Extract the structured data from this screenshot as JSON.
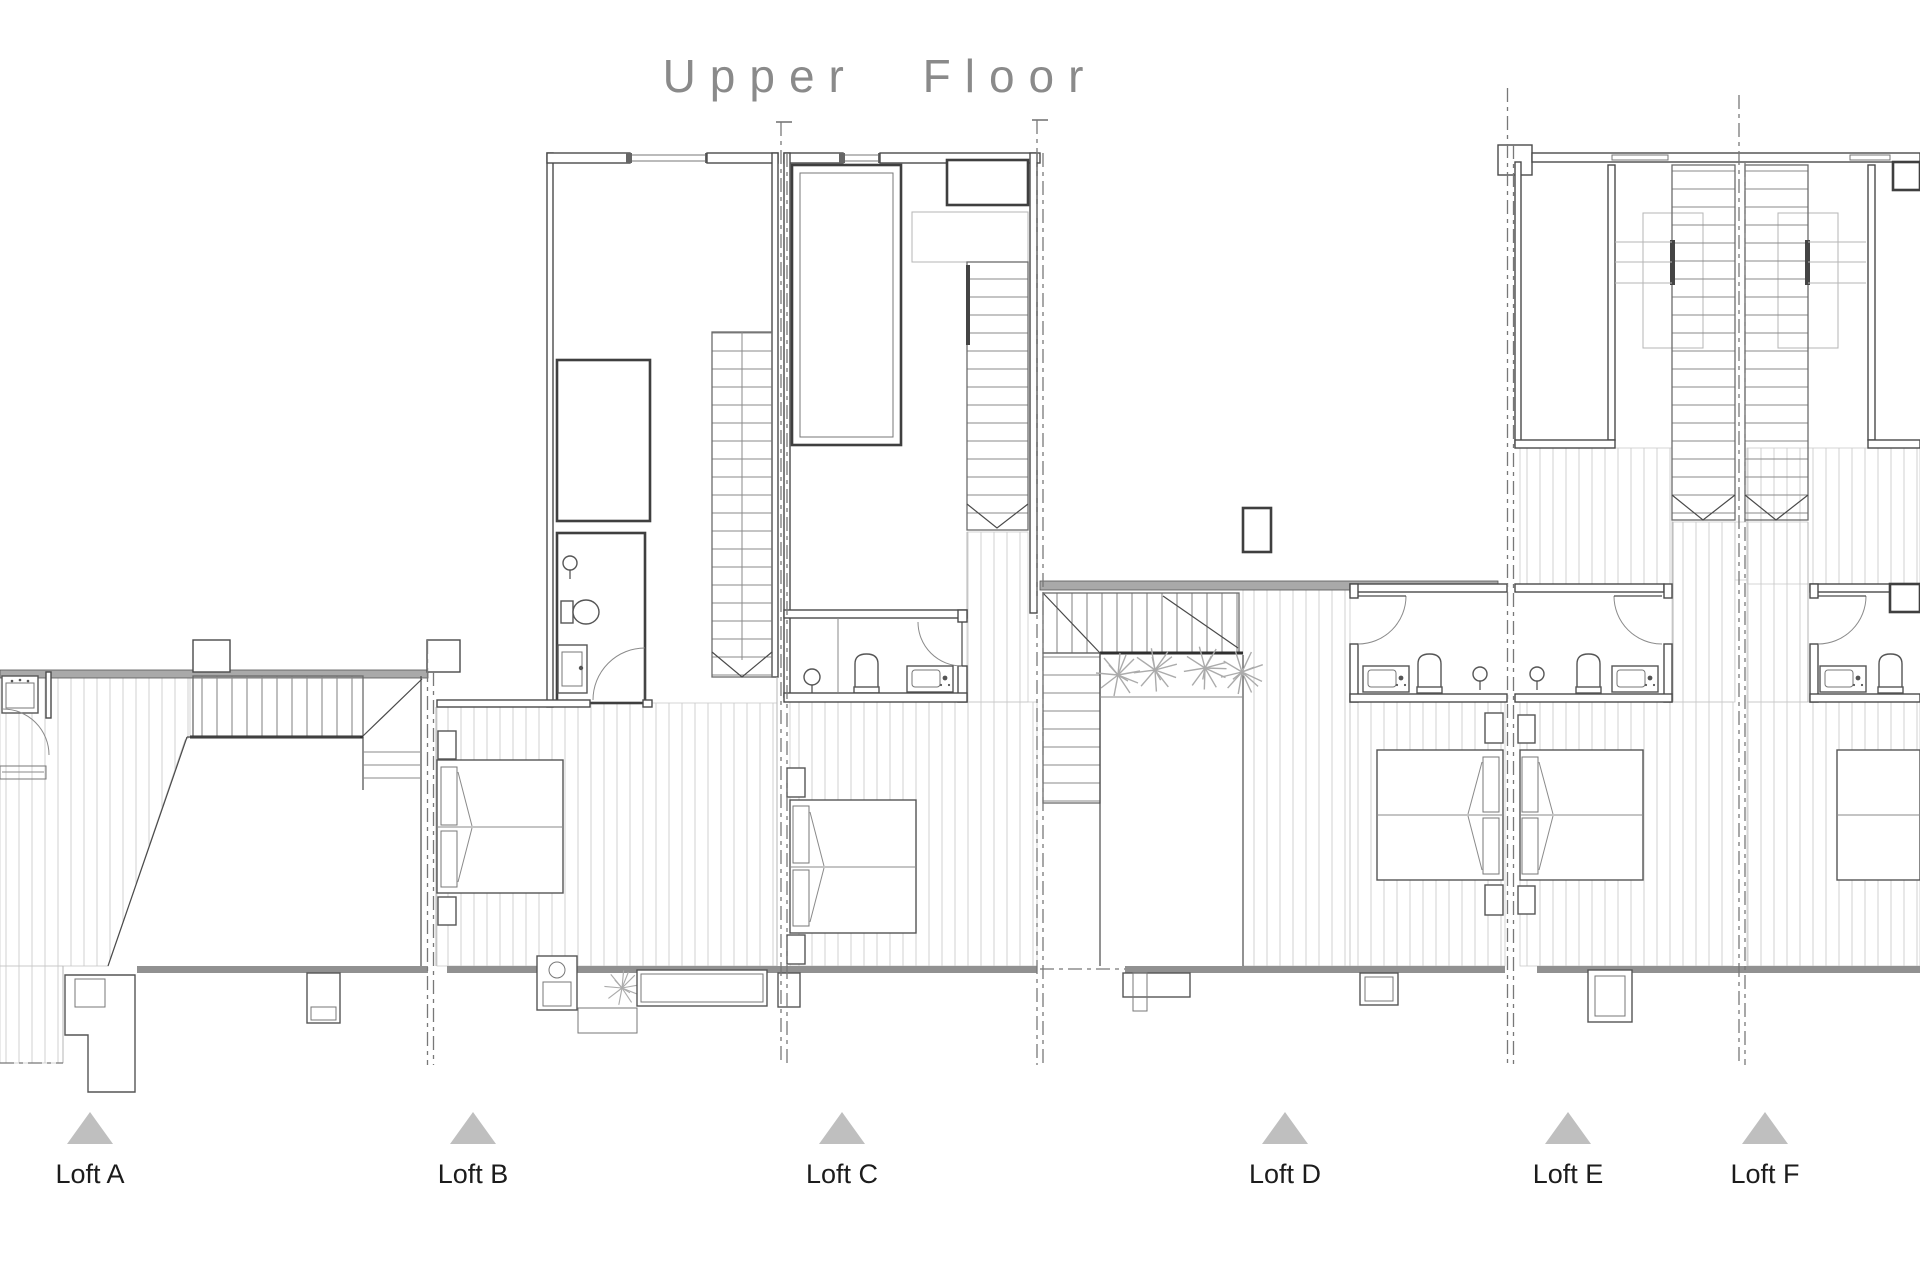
{
  "title": "Upper Floor",
  "drawing_type": "architectural-floor-plan",
  "lofts": [
    {
      "id": "loft-a",
      "label": "Loft A"
    },
    {
      "id": "loft-b",
      "label": "Loft B"
    },
    {
      "id": "loft-c",
      "label": "Loft C"
    },
    {
      "id": "loft-d",
      "label": "Loft D"
    },
    {
      "id": "loft-e",
      "label": "Loft E"
    },
    {
      "id": "loft-f",
      "label": "Loft F"
    }
  ],
  "marker": {
    "shape": "triangle-up",
    "color": "#bfbfbf"
  },
  "colors": {
    "background": "#ffffff",
    "wall_line": "#4a4a4a",
    "thick_gray_wall": "#919191",
    "floor_hatch": "#d6d6d6",
    "stair_tread": "#8a8a8a",
    "party_line_dashed": "#787878",
    "title_text": "#8a8a8a",
    "label_text": "#1c1c1c",
    "plant": "#ababab"
  },
  "depicted_elements": {
    "staircases": [
      "loft-a",
      "loft-b",
      "loft-c",
      "loft-d",
      "loft-e",
      "loft-f"
    ],
    "double_beds": [
      "loft-b",
      "loft-c",
      "loft-d",
      "loft-e",
      "loft-f"
    ],
    "bathrooms": [
      "loft-a",
      "loft-b",
      "loft-c",
      "loft-d",
      "loft-e",
      "loft-f"
    ],
    "plants_count": {
      "loft-b": 1,
      "loft-d": 4
    },
    "terrace_band": "bottom edge of all lofts"
  }
}
